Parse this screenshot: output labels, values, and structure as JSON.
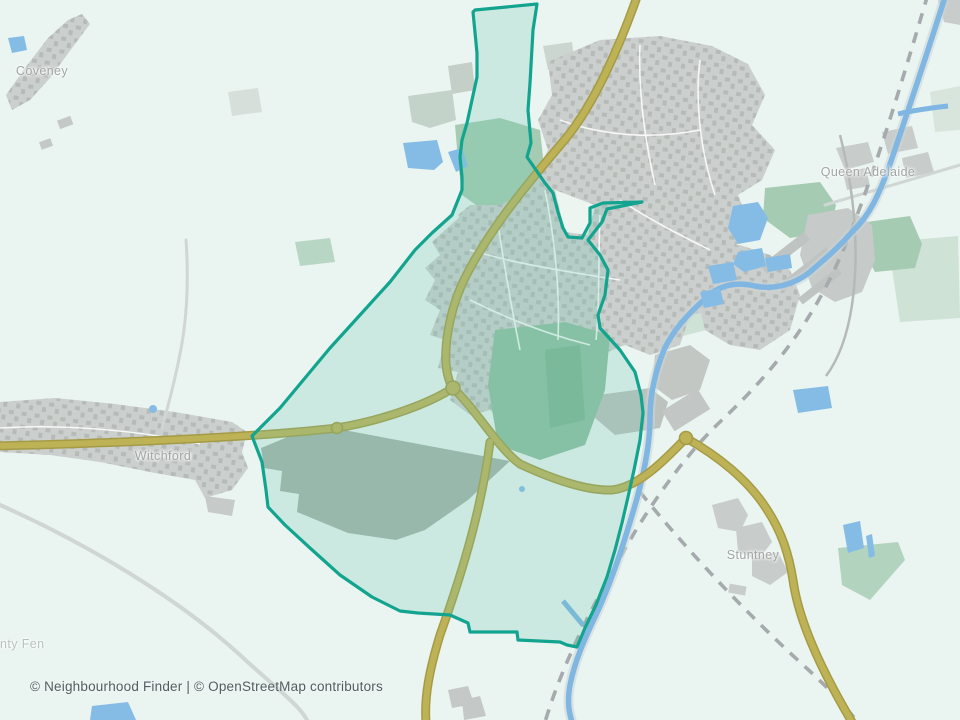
{
  "map": {
    "attribution": "© Neighbourhood Finder | © OpenStreetMap contributors",
    "labels": [
      {
        "id": "coveney",
        "text": "Coveney"
      },
      {
        "id": "witchford",
        "text": "Witchford"
      },
      {
        "id": "queen-adelaide",
        "text": "Queen Adelaide"
      },
      {
        "id": "stuntney",
        "text": "Stuntney"
      },
      {
        "id": "county-fen",
        "text": "nty Fen"
      }
    ],
    "boundary": {
      "name": "highlighted neighbourhood boundary (Ely)",
      "stroke_color": "#12a48e",
      "fill_color": "rgba(110,200,175,0.24)"
    },
    "colors": {
      "background": "#eaf4f1",
      "road_primary": "#beb257",
      "road_casing": "#a59b45",
      "road_minor": "#d0d6d3",
      "water": "#7fb6e2",
      "railway_dash": "#a6aaad",
      "urban": "#cbcfcd",
      "urban_texture": "#b6bbb8",
      "greenspace_bright": "#a5ccb2",
      "greenspace_pale": "#cfe2d6",
      "farmland_grey": "#a6b3ab",
      "label_text": "#9fa7a4",
      "attribution_text": "#525c60"
    }
  }
}
